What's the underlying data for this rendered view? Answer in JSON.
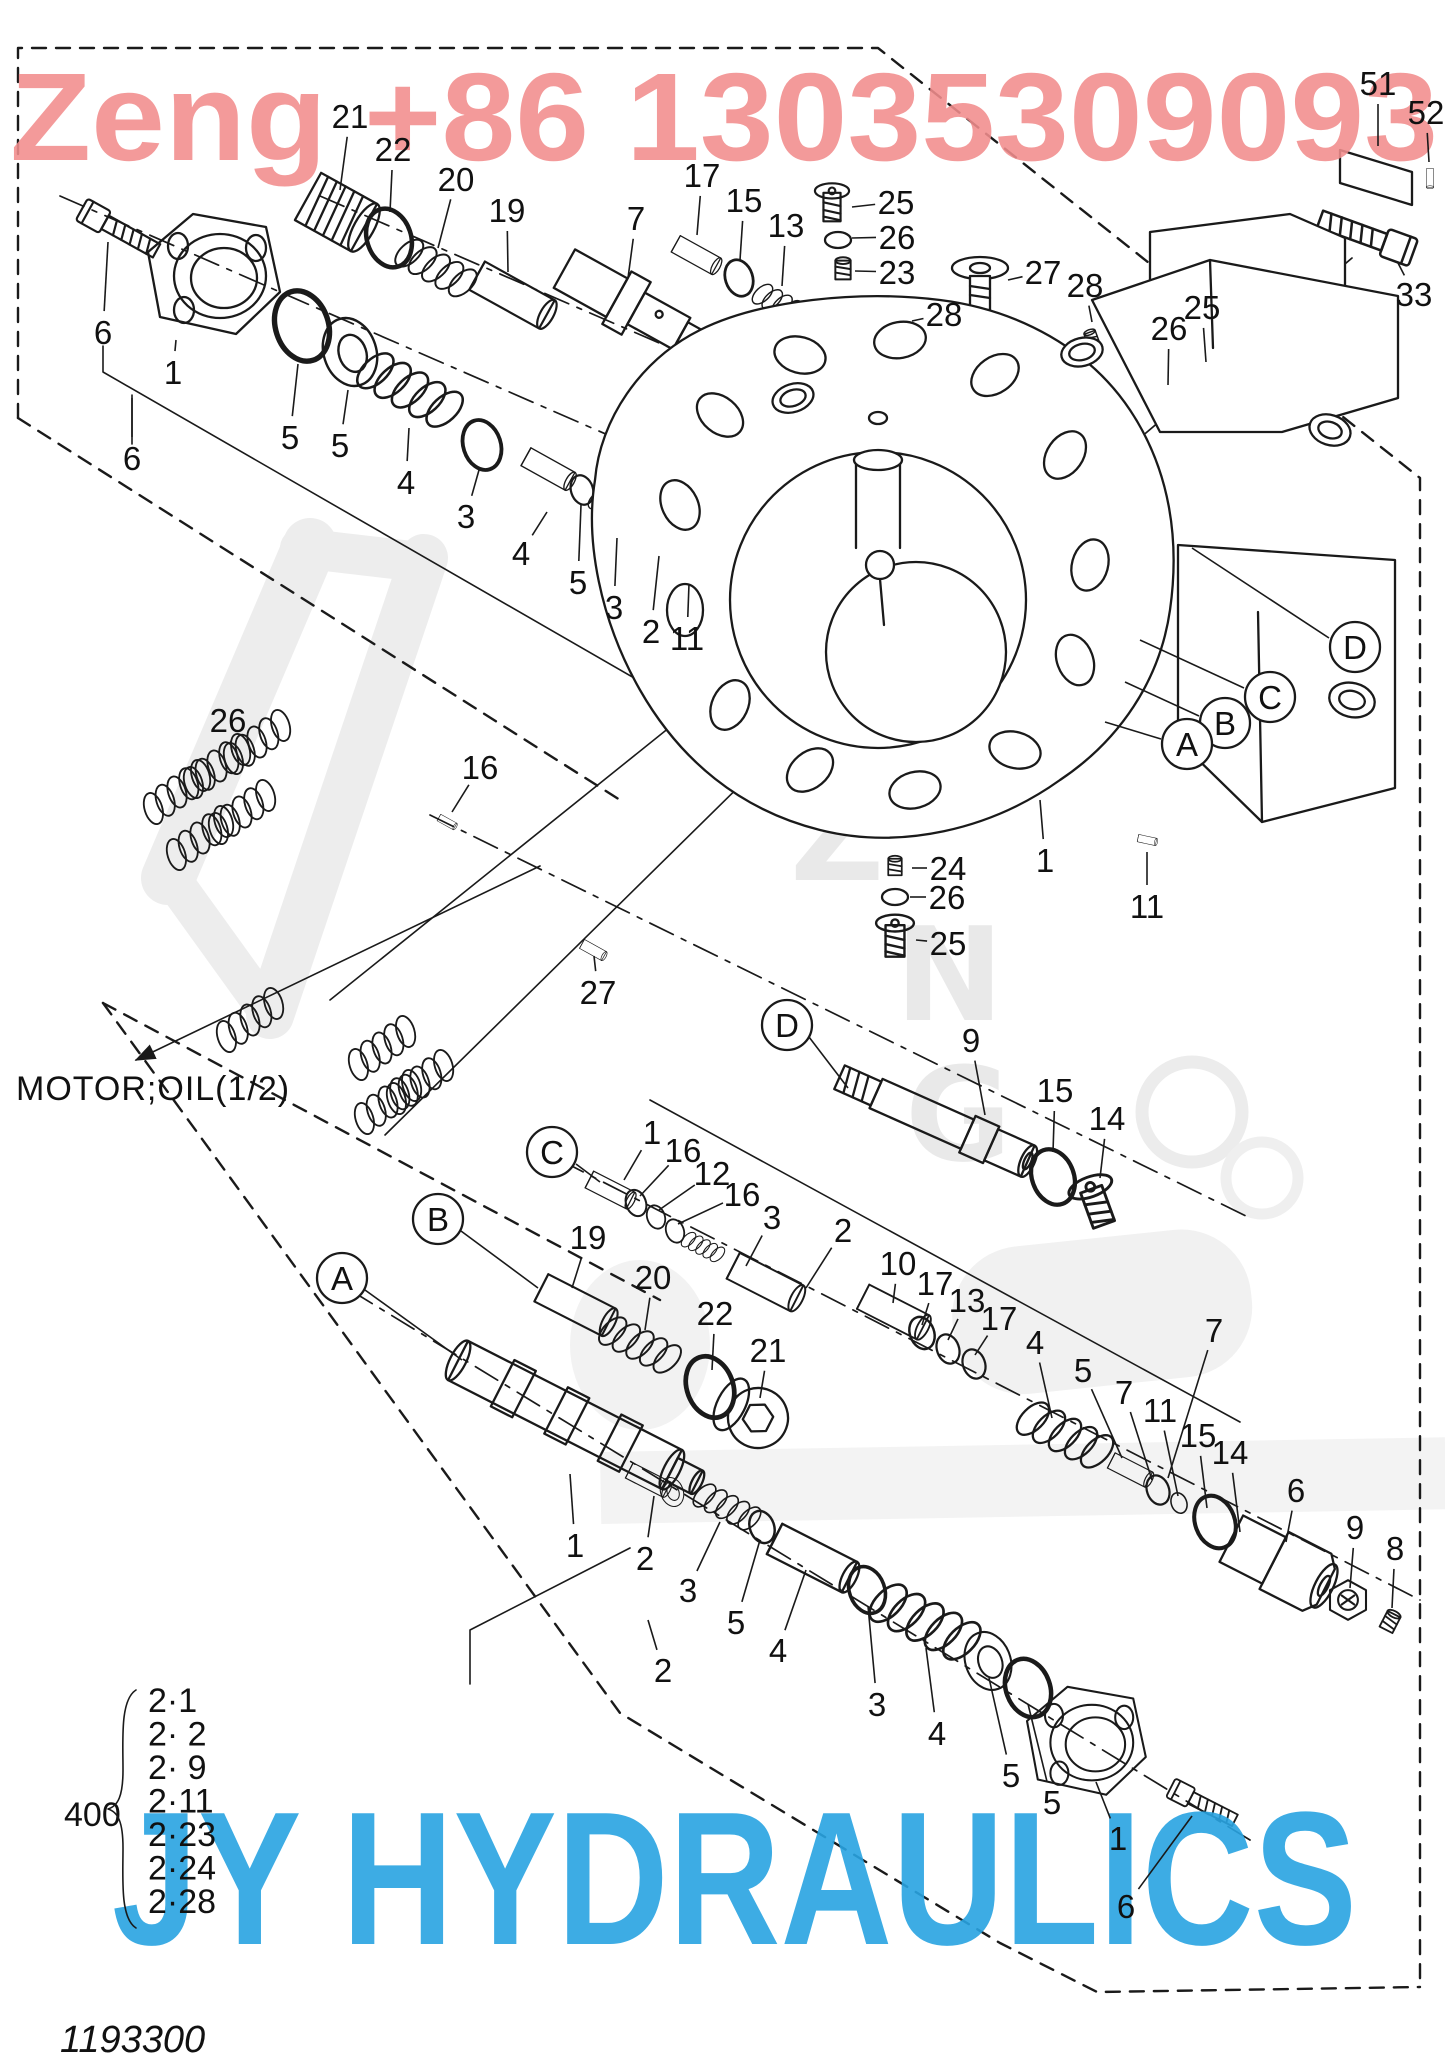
{
  "watermark": {
    "top": "Zeng +86 13035309093",
    "top_color": "#f28d8d",
    "bottom": "JY HYDRAULICS",
    "bottom_color": "#29a4e2",
    "ghost_letters": [
      "Z",
      "N",
      "G"
    ]
  },
  "motor_label": "MOTOR;OIL(1/2)",
  "doc_number": "1193300",
  "ref_group": {
    "number": "400",
    "items": [
      "2·1",
      "2· 2",
      "2· 9",
      "2·11",
      "2·23",
      "2·24",
      "2·28"
    ]
  },
  "labels": [
    {
      "t": "21",
      "x": 350,
      "y": 116,
      "l": [
        340,
        190
      ]
    },
    {
      "t": "22",
      "x": 393,
      "y": 149,
      "l": [
        390,
        212
      ]
    },
    {
      "t": "20",
      "x": 456,
      "y": 179,
      "l": [
        438,
        248
      ]
    },
    {
      "t": "19",
      "x": 507,
      "y": 210,
      "l": [
        508,
        272
      ]
    },
    {
      "t": "7",
      "x": 636,
      "y": 218,
      "l": [
        628,
        278
      ]
    },
    {
      "t": "17",
      "x": 702,
      "y": 175,
      "l": [
        697,
        235
      ]
    },
    {
      "t": "15",
      "x": 744,
      "y": 200,
      "l": [
        740,
        260
      ]
    },
    {
      "t": "13",
      "x": 786,
      "y": 225,
      "l": [
        782,
        286
      ]
    },
    {
      "t": "25",
      "x": 896,
      "y": 202,
      "l": [
        852,
        207
      ]
    },
    {
      "t": "26",
      "x": 897,
      "y": 237,
      "l": [
        852,
        238
      ]
    },
    {
      "t": "23",
      "x": 897,
      "y": 272,
      "l": [
        855,
        271
      ]
    },
    {
      "t": "27",
      "x": 1043,
      "y": 272,
      "l": [
        1008,
        280
      ]
    },
    {
      "t": "28",
      "x": 944,
      "y": 314,
      "l": [
        912,
        321
      ]
    },
    {
      "t": "28",
      "x": 1085,
      "y": 285,
      "l": [
        1092,
        322
      ]
    },
    {
      "t": "26",
      "x": 1169,
      "y": 328,
      "l": [
        1168,
        385
      ]
    },
    {
      "t": "25",
      "x": 1202,
      "y": 307,
      "l": [
        1206,
        362
      ]
    },
    {
      "t": "51",
      "x": 1378,
      "y": 83,
      "l": [
        1378,
        146
      ]
    },
    {
      "t": "52",
      "x": 1426,
      "y": 112,
      "l": [
        1429,
        162
      ]
    },
    {
      "t": "33",
      "x": 1414,
      "y": 294,
      "l": [
        1398,
        263
      ]
    },
    {
      "t": "6",
      "x": 103,
      "y": 332,
      "l": [
        108,
        242
      ]
    },
    {
      "t": "1",
      "x": 173,
      "y": 372,
      "l": [
        176,
        340
      ]
    },
    {
      "t": "6",
      "x": 132,
      "y": 458,
      "l": [
        132,
        398
      ]
    },
    {
      "t": "5",
      "x": 290,
      "y": 437,
      "l": [
        298,
        364
      ]
    },
    {
      "t": "5",
      "x": 340,
      "y": 445,
      "l": [
        348,
        390
      ]
    },
    {
      "t": "4",
      "x": 406,
      "y": 482,
      "l": [
        409,
        428
      ]
    },
    {
      "t": "3",
      "x": 466,
      "y": 516,
      "l": [
        479,
        470
      ]
    },
    {
      "t": "4",
      "x": 521,
      "y": 553,
      "l": [
        547,
        512
      ]
    },
    {
      "t": "5",
      "x": 578,
      "y": 582,
      "l": [
        581,
        505
      ]
    },
    {
      "t": "3",
      "x": 614,
      "y": 607,
      "l": [
        617,
        538
      ]
    },
    {
      "t": "2",
      "x": 651,
      "y": 631,
      "l": [
        659,
        556
      ]
    },
    {
      "t": "11",
      "x": 687,
      "y": 638,
      "l": [
        689,
        584
      ]
    },
    {
      "t": "26",
      "x": 228,
      "y": 720,
      "l": [
        232,
        752
      ]
    },
    {
      "t": "16",
      "x": 480,
      "y": 767,
      "l": [
        452,
        812
      ]
    },
    {
      "t": "27",
      "x": 598,
      "y": 992,
      "l": [
        594,
        956
      ]
    },
    {
      "t": "24",
      "x": 948,
      "y": 868,
      "l": [
        912,
        868
      ]
    },
    {
      "t": "26",
      "x": 947,
      "y": 897,
      "l": [
        910,
        897
      ]
    },
    {
      "t": "25",
      "x": 948,
      "y": 943,
      "l": [
        916,
        940
      ]
    },
    {
      "t": "1",
      "x": 1045,
      "y": 860,
      "l": [
        1040,
        800
      ]
    },
    {
      "t": "11",
      "x": 1147,
      "y": 906,
      "l": [
        1147,
        852
      ]
    },
    {
      "t": "D",
      "c": true,
      "x": 1355,
      "y": 647,
      "l": [
        1329,
        638,
        1192,
        548
      ]
    },
    {
      "t": "C",
      "c": true,
      "x": 1270,
      "y": 697,
      "l": [
        1244,
        688,
        1140,
        640
      ]
    },
    {
      "t": "B",
      "c": true,
      "x": 1225,
      "y": 723,
      "l": [
        1199,
        716,
        1125,
        682
      ]
    },
    {
      "t": "A",
      "c": true,
      "x": 1187,
      "y": 744,
      "l": [
        1161,
        739,
        1105,
        722
      ]
    },
    {
      "t": "D",
      "c": true,
      "x": 787,
      "y": 1025,
      "l": [
        809,
        1037,
        848,
        1088
      ]
    },
    {
      "t": "9",
      "x": 971,
      "y": 1040,
      "l": [
        985,
        1115
      ]
    },
    {
      "t": "15",
      "x": 1055,
      "y": 1090,
      "l": [
        1053,
        1152
      ]
    },
    {
      "t": "14",
      "x": 1107,
      "y": 1118,
      "l": [
        1100,
        1178
      ]
    },
    {
      "t": "C",
      "c": true,
      "x": 552,
      "y": 1152,
      "l": [
        576,
        1164,
        600,
        1182
      ]
    },
    {
      "t": "1",
      "x": 652,
      "y": 1132,
      "l": [
        624,
        1180
      ]
    },
    {
      "t": "16",
      "x": 683,
      "y": 1150,
      "l": [
        640,
        1196
      ]
    },
    {
      "t": "12",
      "x": 712,
      "y": 1173,
      "l": [
        659,
        1210
      ]
    },
    {
      "t": "16",
      "x": 742,
      "y": 1194,
      "l": [
        678,
        1224
      ]
    },
    {
      "t": "3",
      "x": 772,
      "y": 1217,
      "l": [
        746,
        1266
      ]
    },
    {
      "t": "2",
      "x": 843,
      "y": 1230,
      "l": [
        806,
        1288
      ]
    },
    {
      "t": "10",
      "x": 898,
      "y": 1263,
      "l": [
        893,
        1303
      ]
    },
    {
      "t": "17",
      "x": 935,
      "y": 1283,
      "l": [
        922,
        1325
      ]
    },
    {
      "t": "13",
      "x": 967,
      "y": 1300,
      "l": [
        948,
        1340
      ]
    },
    {
      "t": "17",
      "x": 999,
      "y": 1318,
      "l": [
        975,
        1355
      ]
    },
    {
      "t": "4",
      "x": 1035,
      "y": 1342,
      "l": [
        1052,
        1418
      ]
    },
    {
      "t": "5",
      "x": 1083,
      "y": 1370,
      "l": [
        1122,
        1458
      ]
    },
    {
      "t": "7",
      "x": 1214,
      "y": 1330,
      "l": [
        1168,
        1478
      ]
    },
    {
      "t": "7",
      "x": 1124,
      "y": 1392,
      "l": [
        1152,
        1480
      ]
    },
    {
      "t": "11",
      "x": 1160,
      "y": 1410,
      "l": [
        1178,
        1496
      ]
    },
    {
      "t": "15",
      "x": 1198,
      "y": 1435,
      "l": [
        1207,
        1508
      ]
    },
    {
      "t": "14",
      "x": 1230,
      "y": 1452,
      "l": [
        1240,
        1532
      ]
    },
    {
      "t": "B",
      "c": true,
      "x": 438,
      "y": 1219,
      "l": [
        461,
        1231,
        538,
        1288
      ]
    },
    {
      "t": "19",
      "x": 588,
      "y": 1237,
      "l": [
        572,
        1288
      ]
    },
    {
      "t": "20",
      "x": 653,
      "y": 1277,
      "l": [
        645,
        1330
      ]
    },
    {
      "t": "22",
      "x": 715,
      "y": 1313,
      "l": [
        712,
        1370
      ]
    },
    {
      "t": "21",
      "x": 768,
      "y": 1350,
      "l": [
        760,
        1398
      ]
    },
    {
      "t": "A",
      "c": true,
      "x": 342,
      "y": 1278,
      "l": [
        365,
        1290,
        462,
        1360
      ]
    },
    {
      "t": "6",
      "x": 1296,
      "y": 1490,
      "l": [
        1286,
        1542
      ]
    },
    {
      "t": "9",
      "x": 1355,
      "y": 1527,
      "l": [
        1350,
        1588
      ]
    },
    {
      "t": "8",
      "x": 1395,
      "y": 1548,
      "l": [
        1392,
        1608
      ]
    },
    {
      "t": "1",
      "x": 575,
      "y": 1545,
      "l": [
        570,
        1474
      ]
    },
    {
      "t": "2",
      "x": 645,
      "y": 1558,
      "l": [
        654,
        1496
      ]
    },
    {
      "t": "3",
      "x": 688,
      "y": 1590,
      "l": [
        720,
        1522
      ]
    },
    {
      "t": "5",
      "x": 736,
      "y": 1622,
      "l": [
        760,
        1540
      ]
    },
    {
      "t": "4",
      "x": 778,
      "y": 1650,
      "l": [
        806,
        1570
      ]
    },
    {
      "t": "2",
      "x": 663,
      "y": 1670,
      "l": [
        648,
        1620
      ]
    },
    {
      "t": "3",
      "x": 877,
      "y": 1704,
      "l": [
        868,
        1606
      ]
    },
    {
      "t": "4",
      "x": 937,
      "y": 1733,
      "l": [
        926,
        1648
      ]
    },
    {
      "t": "5",
      "x": 1011,
      "y": 1775,
      "l": [
        989,
        1678
      ]
    },
    {
      "t": "5",
      "x": 1052,
      "y": 1802,
      "l": [
        1028,
        1704
      ]
    },
    {
      "t": "1",
      "x": 1118,
      "y": 1838,
      "l": [
        1096,
        1782
      ]
    },
    {
      "t": "6",
      "x": 1126,
      "y": 1906,
      "l": [
        1192,
        1816
      ]
    }
  ]
}
